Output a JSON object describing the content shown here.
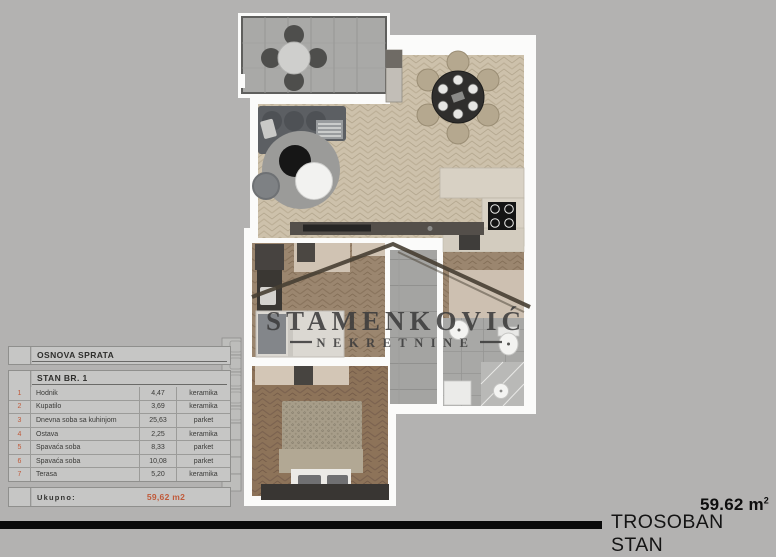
{
  "window": {
    "background": "#b3b2b1"
  },
  "plan_table": {
    "section_title": "OSNOVA SPRATA",
    "unit_title": "STAN BR. 1",
    "rows": [
      {
        "num": "1",
        "name": "Hodnik",
        "area": "4,47",
        "floor": "keramika"
      },
      {
        "num": "2",
        "name": "Kupatilo",
        "area": "3,69",
        "floor": "keramika"
      },
      {
        "num": "3",
        "name": "Dnevna soba sa kuhinjom",
        "area": "25,63",
        "floor": "parket"
      },
      {
        "num": "4",
        "name": "Ostava",
        "area": "2,25",
        "floor": "keramika"
      },
      {
        "num": "5",
        "name": "Spavaća soba",
        "area": "8,33",
        "floor": "parket"
      },
      {
        "num": "6",
        "name": "Spavaća soba",
        "area": "10,08",
        "floor": "parket"
      },
      {
        "num": "7",
        "name": "Terasa",
        "area": "5,20",
        "floor": "keramika"
      }
    ],
    "total_label": "Ukupno:",
    "total_value": "59,62 m2",
    "accent_color": "#c05a3a"
  },
  "floorplan": {
    "watermark_line1": "STAMENKOVIĆ",
    "watermark_line2": "NEKRETNINE"
  },
  "footer": {
    "area_value": "59.62 m",
    "area_superscript": "2",
    "apartment_type": "TROSOBAN STAN"
  }
}
